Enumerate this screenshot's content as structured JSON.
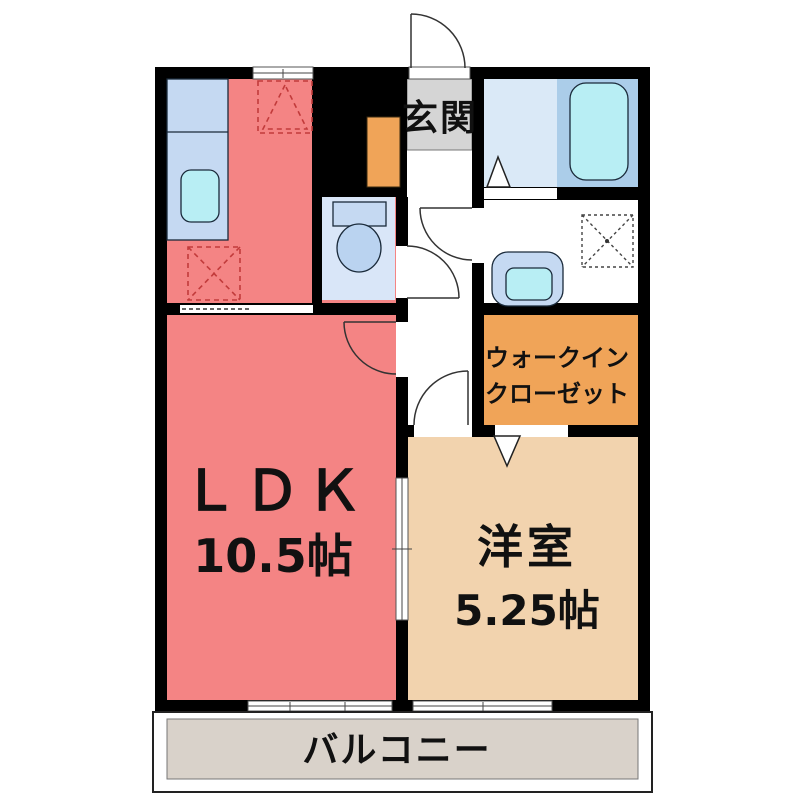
{
  "plan": {
    "type": "japanese-apartment-floor-plan",
    "rooms": {
      "genkan": {
        "label": "玄関"
      },
      "ldk": {
        "label": "ＬＤＫ",
        "size": "10.5帖"
      },
      "western": {
        "label": "洋室",
        "size": "5.25帖"
      },
      "closet": {
        "label_line1": "ウォークイン",
        "label_line2": "クローゼット"
      },
      "balcony": {
        "label": "バルコニー"
      },
      "toilet": {
        "label": ""
      },
      "bathroom": {
        "label": ""
      },
      "washroom": {
        "label": ""
      }
    },
    "fixtures": [
      "kitchen-counter",
      "kitchen-sink",
      "gas-stove-space",
      "refrigerator-space",
      "toilet",
      "bathtub",
      "washbasin",
      "washing-machine-space",
      "shoe-cabinet"
    ],
    "colors": {
      "wall": "#000000",
      "ldk": "#F48484",
      "western": "#F2D3AE",
      "closet": "#F0A458",
      "shoe_cabinet": "#F0A458",
      "balcony": "#D9D2CA",
      "genkan": "#D5D5D5",
      "bath_floor": "#DAE9F7",
      "tub_zone": "#ABCDE9",
      "toilet_floor": "#D9E6F8",
      "counter_blue": "#C5D9F2",
      "basin_cyan": "#B8EEF4",
      "toilet_bowl": "#BAD3F0",
      "hallway": "#FFFFFF"
    }
  }
}
